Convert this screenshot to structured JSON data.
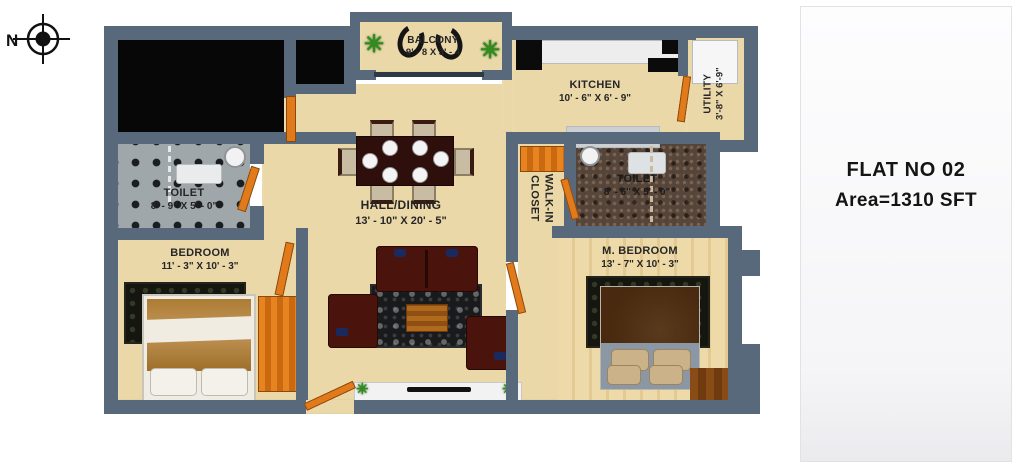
{
  "compass": {
    "label": "N"
  },
  "info_panel": {
    "flat_no": "FLAT NO 02",
    "area": "Area=1310 SFT"
  },
  "rooms": {
    "balcony": {
      "name": "BALCONY",
      "dims": "9' - 8 X 3' - 4"
    },
    "kitchen": {
      "name": "KITCHEN",
      "dims": "10' - 6\" X 6' - 9\""
    },
    "utility": {
      "name": "UTILITY",
      "dims": "3'-8\" X 6'-9\""
    },
    "toilet_left": {
      "name": "TOILET",
      "dims": "8' - 9\" X 5' - 0\""
    },
    "toilet_right": {
      "name": "TOILET",
      "dims": "8' - 6\" X 5' - 0\""
    },
    "hall_dining": {
      "name": "HALL/DINING",
      "dims": "13' - 10\" X 20' - 5\""
    },
    "walk_in_closet": {
      "name": "WALK-IN CLOSET"
    },
    "bedroom": {
      "name": "BEDROOM",
      "dims": "11' - 3\" X 10' - 3\""
    },
    "master_bedroom": {
      "name": "M. BEDROOM",
      "dims": "13' - 7\" X 10' - 3\""
    }
  },
  "decor": {
    "plant_glyph": "✳"
  },
  "colors": {
    "wall": "#57697b",
    "floor_beige": "#ebd8a9",
    "void_black": "#070707",
    "door_orange": "#e07a1a",
    "sofa_maroon": "#4a140c",
    "wood_floor": "#e9d49d",
    "plant_green": "#2f8c1d",
    "label_text": "#262626",
    "panel_bg": "#f9f9fb"
  }
}
